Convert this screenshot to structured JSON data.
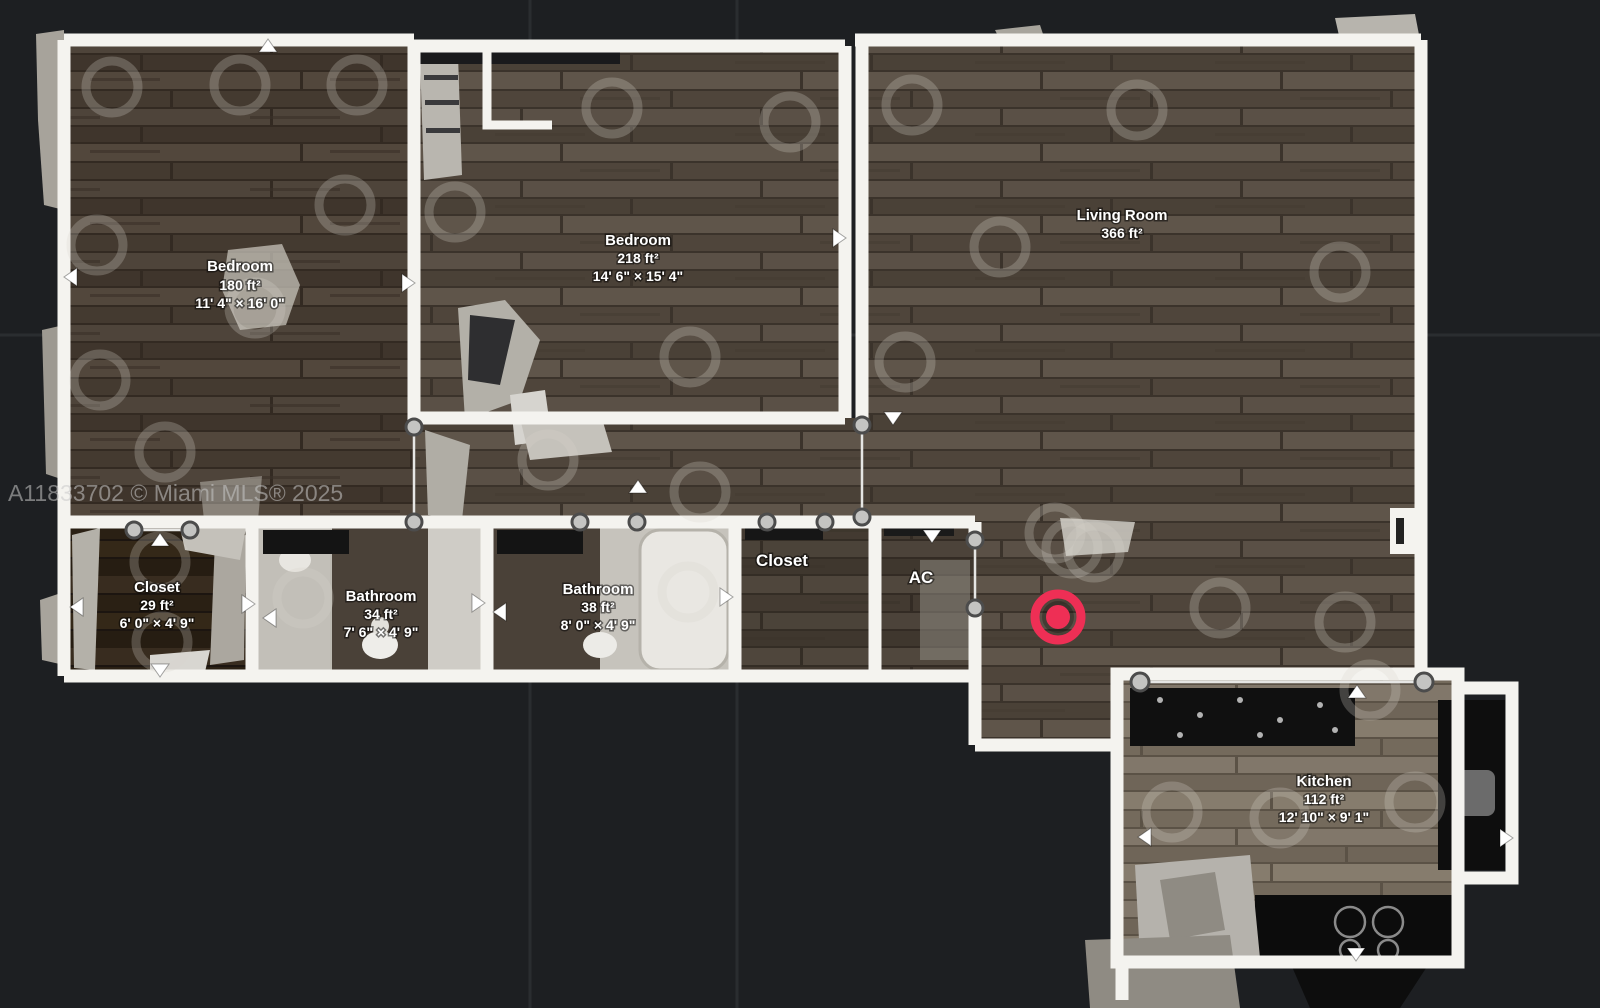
{
  "watermark": "A11833702 © Miami MLS® 2025",
  "colors": {
    "background": "#1d1f22",
    "wall": "#f4f3ef",
    "marker": "#ee2f55"
  },
  "rooms": {
    "bedroom1": {
      "name": "Bedroom",
      "area": "180 ft²",
      "dims": "11' 4\" × 16' 0\""
    },
    "bedroom2": {
      "name": "Bedroom",
      "area": "218 ft²",
      "dims": "14' 6\" × 15' 4\""
    },
    "living": {
      "name": "Living Room",
      "area": "366 ft²"
    },
    "closet1": {
      "name": "Closet",
      "area": "29 ft²",
      "dims": "6' 0\" × 4' 9\""
    },
    "bath1": {
      "name": "Bathroom",
      "area": "34 ft²",
      "dims": "7' 6\" × 4' 9\""
    },
    "bath2": {
      "name": "Bathroom",
      "area": "38 ft²",
      "dims": "8' 0\" × 4' 9\""
    },
    "closet2": {
      "name": "Closet"
    },
    "ac": {
      "name": "AC"
    },
    "kitchen": {
      "name": "Kitchen",
      "area": "112 ft²",
      "dims": "12' 10\" × 9' 1\""
    }
  }
}
